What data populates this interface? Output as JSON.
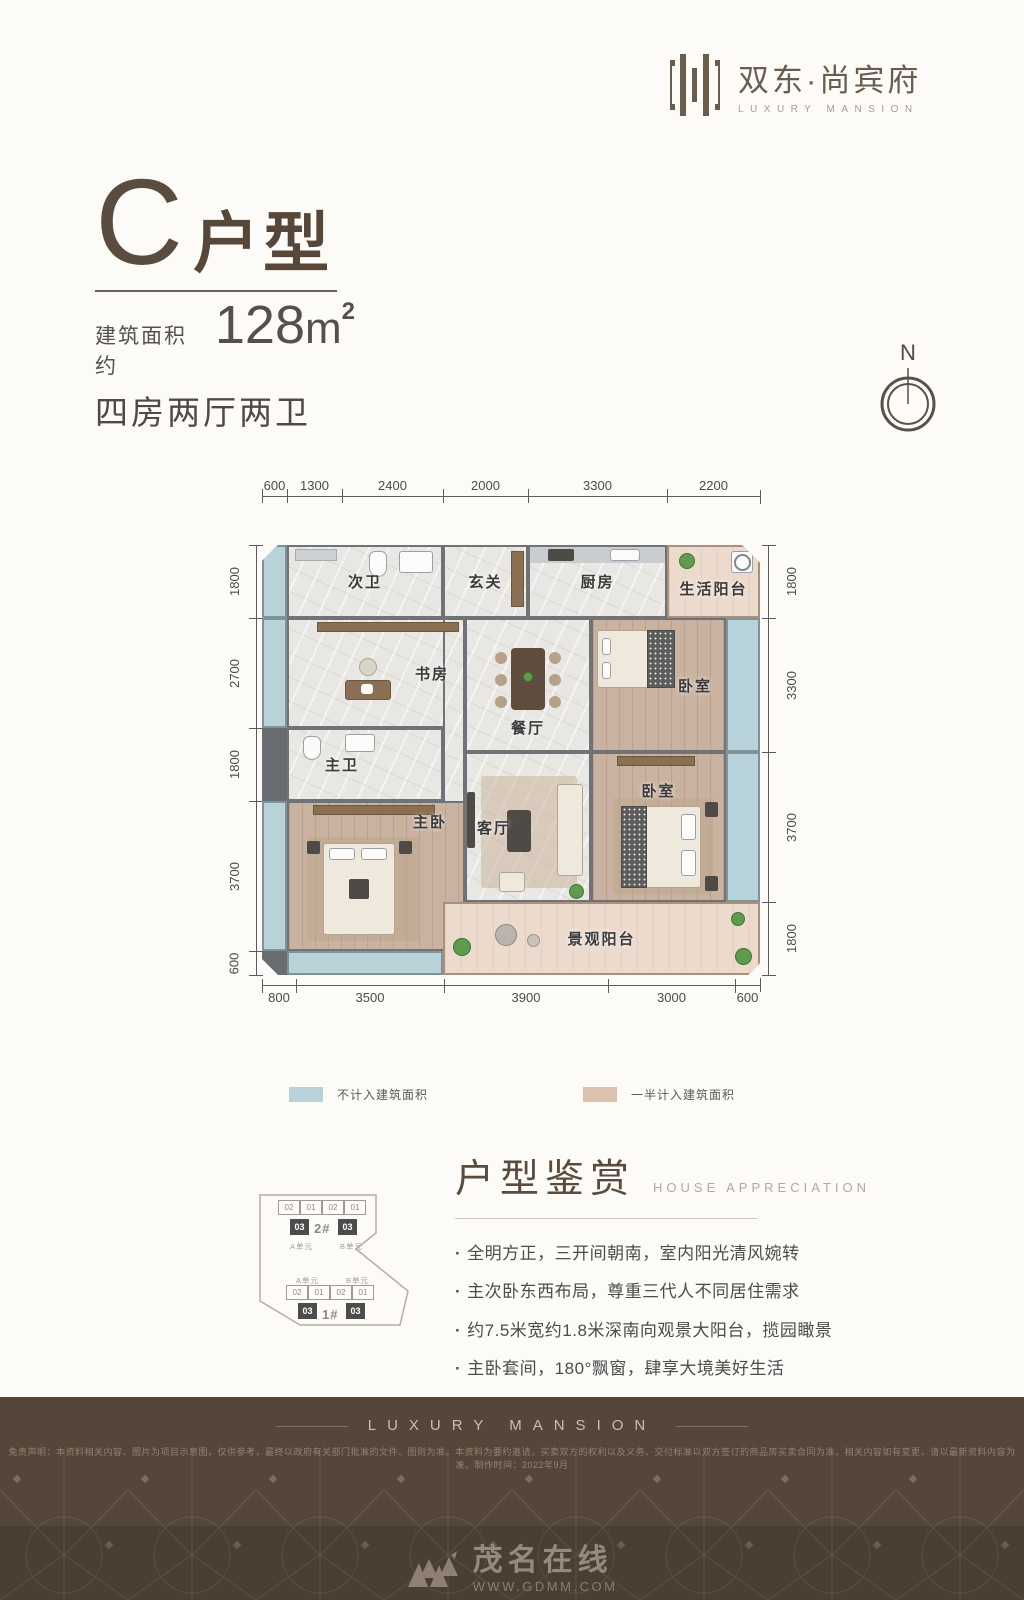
{
  "logo": {
    "brand": "双东·尚宾府",
    "tagline": "LUXURY MANSION"
  },
  "title": {
    "letter": "C",
    "type_suffix": "户型",
    "area_label": "建筑面积约",
    "area_number": "128",
    "area_unit": "m",
    "area_exp": "2",
    "layout_text": "四房两厅两卫"
  },
  "compass": {
    "north": "N"
  },
  "floorplan": {
    "dims_top": [
      "600",
      "1300",
      "2400",
      "2000",
      "3300",
      "2200"
    ],
    "dims_left": [
      "1800",
      "2700",
      "1800",
      "3700",
      "600"
    ],
    "dims_right": [
      "1800",
      "3300",
      "3700",
      "1800"
    ],
    "dims_bottom": [
      "800",
      "3500",
      "3900",
      "3000",
      "600"
    ],
    "rooms": {
      "second_bath": "次卫",
      "foyer": "玄关",
      "kitchen": "厨房",
      "service_balcony": "生活阳台",
      "study": "书房",
      "dining": "餐厅",
      "bedroom_north": "卧室",
      "master_bath": "主卫",
      "master_bedroom": "主卧",
      "living": "客厅",
      "bedroom_east": "卧室",
      "view_balcony": "景观阳台"
    }
  },
  "legend": {
    "not_counted": {
      "color": "#b7d2d8",
      "label": "不计入建筑面积"
    },
    "half_counted": {
      "color": "#dcc2ad",
      "label": "一半计入建筑面积"
    }
  },
  "keyplan": {
    "building_top": {
      "name": "2#",
      "units": [
        "02",
        "01",
        "02",
        "01"
      ],
      "core": "03",
      "unit_a": "A单元",
      "unit_b": "B单元"
    },
    "building_bottom": {
      "name": "1#",
      "units": [
        "02",
        "01",
        "02",
        "01"
      ],
      "core": "03",
      "unit_a": "A单元",
      "unit_b": "B单元"
    }
  },
  "appreciation": {
    "title": "户型鉴赏",
    "subtitle": "HOUSE APPRECIATION",
    "bullets": [
      "全明方正，三开间朝南，室内阳光清风婉转",
      "主次卧东西布局，尊重三代人不同居住需求",
      "约7.5米宽约1.8米深南向观景大阳台，揽园瞰景",
      "主卧套间，180°飘窗，肆享大境美好生活"
    ]
  },
  "footer": {
    "banner": "LUXURY MANSION",
    "disclaimer": "免责声明：本资料相关内容、图片为项目示意图，仅供参考，最终以政府有关部门批准的文件、图则为准。本资料为要约邀请，买卖双方的权利以及义务、交付标准以双方签订的商品房买卖合同为准，相关内容如有变更，请以最新资料内容为准。制作时间：2022年9月",
    "watermark": {
      "name": "茂名在线",
      "site": "WWW.GDMM.COM"
    }
  }
}
